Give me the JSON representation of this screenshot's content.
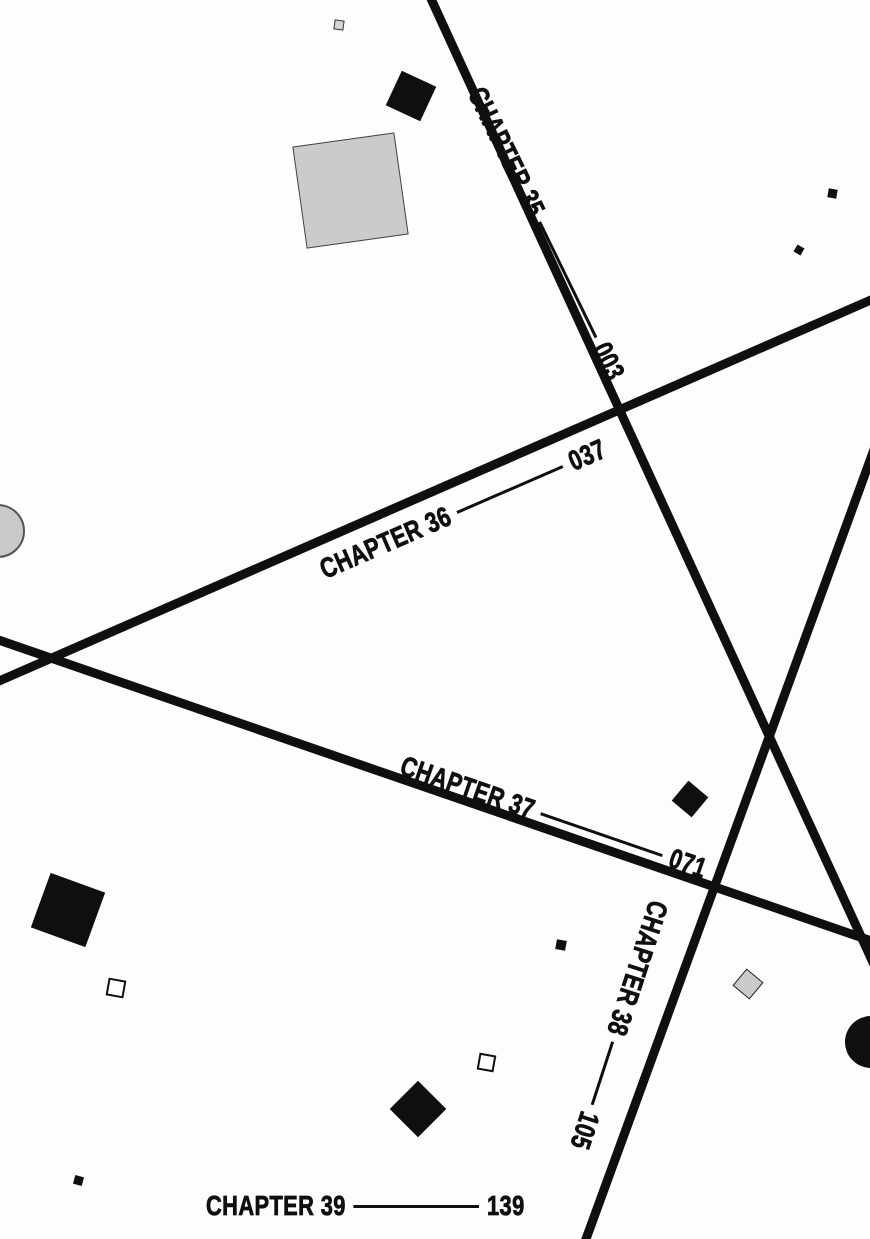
{
  "palette": {
    "ink": "#0f0f0f",
    "gray_fill": "#cbcbcb",
    "gray_fill_light": "#d6d6d6",
    "white_fill": "#ffffff",
    "background": "#fdfdfd"
  },
  "toc": {
    "entries": [
      {
        "chapter": "CHAPTER 35",
        "page": "003"
      },
      {
        "chapter": "CHAPTER 36",
        "page": "037"
      },
      {
        "chapter": "CHAPTER 37",
        "page": "071"
      },
      {
        "chapter": "CHAPTER 38",
        "page": "105"
      },
      {
        "chapter": "CHAPTER 39",
        "page": "139"
      }
    ]
  },
  "rules": [
    {
      "name": "diagonal-rule-chapter-35",
      "x1": 427,
      "y1": -10,
      "x2": 881,
      "y2": 980,
      "width": 9
    },
    {
      "name": "diagonal-rule-chapter-36",
      "x1": -10,
      "y1": 685,
      "x2": 880,
      "y2": 296,
      "width": 9
    },
    {
      "name": "diagonal-rule-chapter-37",
      "x1": -10,
      "y1": 637,
      "x2": 880,
      "y2": 944,
      "width": 9
    },
    {
      "name": "diagonal-rule-chapter-38",
      "x1": 876,
      "y1": 444,
      "x2": 582,
      "y2": 1250,
      "width": 9
    }
  ],
  "decor_shapes": [
    {
      "name": "decor-tiny-gray-square-top",
      "kind": "square",
      "cx": 339,
      "cy": 25,
      "size": 10,
      "rot": 8,
      "fill": "#d6d6d6",
      "stroke": "#333333",
      "sw": 1
    },
    {
      "name": "decor-black-square-top",
      "kind": "square",
      "cx": 411,
      "cy": 96,
      "size": 38,
      "rot": 25,
      "fill": "#0f0f0f"
    },
    {
      "name": "decor-large-gray-square",
      "kind": "square",
      "cx": 350,
      "cy": 190,
      "size": 103,
      "rot": -8,
      "fill": "#cbcbcb",
      "stroke": "#444444",
      "sw": 1
    },
    {
      "name": "decor-tiny-black-square-right-1",
      "kind": "square",
      "cx": 832,
      "cy": 193,
      "size": 9,
      "rot": 10,
      "fill": "#0f0f0f"
    },
    {
      "name": "decor-tiny-black-square-right-2",
      "kind": "square",
      "cx": 799,
      "cy": 250,
      "size": 8,
      "rot": 30,
      "fill": "#0f0f0f"
    },
    {
      "name": "decor-gray-circle-left",
      "kind": "circle",
      "cx": -2,
      "cy": 531,
      "size": 54,
      "rot": 0,
      "fill": "#c9c9c9",
      "stroke": "#555555",
      "sw": 2
    },
    {
      "name": "decor-black-diamond-mid",
      "kind": "square",
      "cx": 690,
      "cy": 799,
      "size": 26,
      "rot": 40,
      "fill": "#0f0f0f"
    },
    {
      "name": "decor-black-square-bottom-left",
      "kind": "square",
      "cx": 68,
      "cy": 910,
      "size": 58,
      "rot": 20,
      "fill": "#0f0f0f"
    },
    {
      "name": "decor-white-square-bottom-left",
      "kind": "square",
      "cx": 116,
      "cy": 988,
      "size": 18,
      "rot": 10,
      "fill": "#ffffff",
      "stroke": "#0f0f0f",
      "sw": 2
    },
    {
      "name": "decor-tiny-black-square-center",
      "kind": "square",
      "cx": 561,
      "cy": 945,
      "size": 10,
      "rot": 10,
      "fill": "#0f0f0f"
    },
    {
      "name": "decor-gray-diamond-right",
      "kind": "square",
      "cx": 748,
      "cy": 984,
      "size": 22,
      "rot": 40,
      "fill": "#cbcbcb",
      "stroke": "#222222",
      "sw": 1.5
    },
    {
      "name": "decor-black-circle-right",
      "kind": "circle",
      "cx": 871,
      "cy": 1042,
      "size": 52,
      "rot": 0,
      "fill": "#0f0f0f"
    },
    {
      "name": "decor-white-square-bottom-center",
      "kind": "square",
      "cx": 486,
      "cy": 1062,
      "size": 17,
      "rot": 10,
      "fill": "#ffffff",
      "stroke": "#0f0f0f",
      "sw": 2
    },
    {
      "name": "decor-black-diamond-bottom",
      "kind": "square",
      "cx": 418,
      "cy": 1109,
      "size": 40,
      "rot": 45,
      "fill": "#0f0f0f"
    },
    {
      "name": "decor-tiny-black-square-bl",
      "kind": "square",
      "cx": 78,
      "cy": 1180,
      "size": 9,
      "rot": 15,
      "fill": "#0f0f0f"
    }
  ]
}
